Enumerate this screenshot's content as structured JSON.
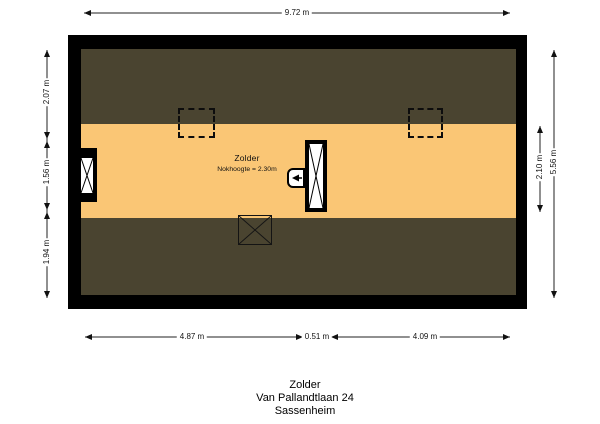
{
  "floor_plan": {
    "room": {
      "name": "Zolder",
      "ridge_height": "Nokhoogte = 2.30m"
    },
    "colors": {
      "wall": "#000000",
      "sloped_roof_area": "#4a4430",
      "floor_area": "#fac675",
      "symbol_fill": "#ffffff",
      "dimension_line": "#222222"
    },
    "symbols": {
      "skylight_left": "dashed-square",
      "skylight_right": "dashed-square",
      "window_left_wall": "window-with-x",
      "staircase": "stair-box-with-x",
      "vent_unit": "arrow-box",
      "floor_hatch": "x-box"
    }
  },
  "dimensions": {
    "top_width": "9.72 m",
    "bottom_segments": [
      "4.87 m",
      "0.51 m",
      "4.09 m"
    ],
    "left_segments": [
      "2.07 m",
      "1.56 m",
      "1.94 m"
    ],
    "right_floor_depth": "2.10 m",
    "right_total_depth": "5.56 m"
  },
  "caption": {
    "floor": "Zolder",
    "street": "Van Pallandtlaan 24",
    "city": "Sassenheim"
  }
}
